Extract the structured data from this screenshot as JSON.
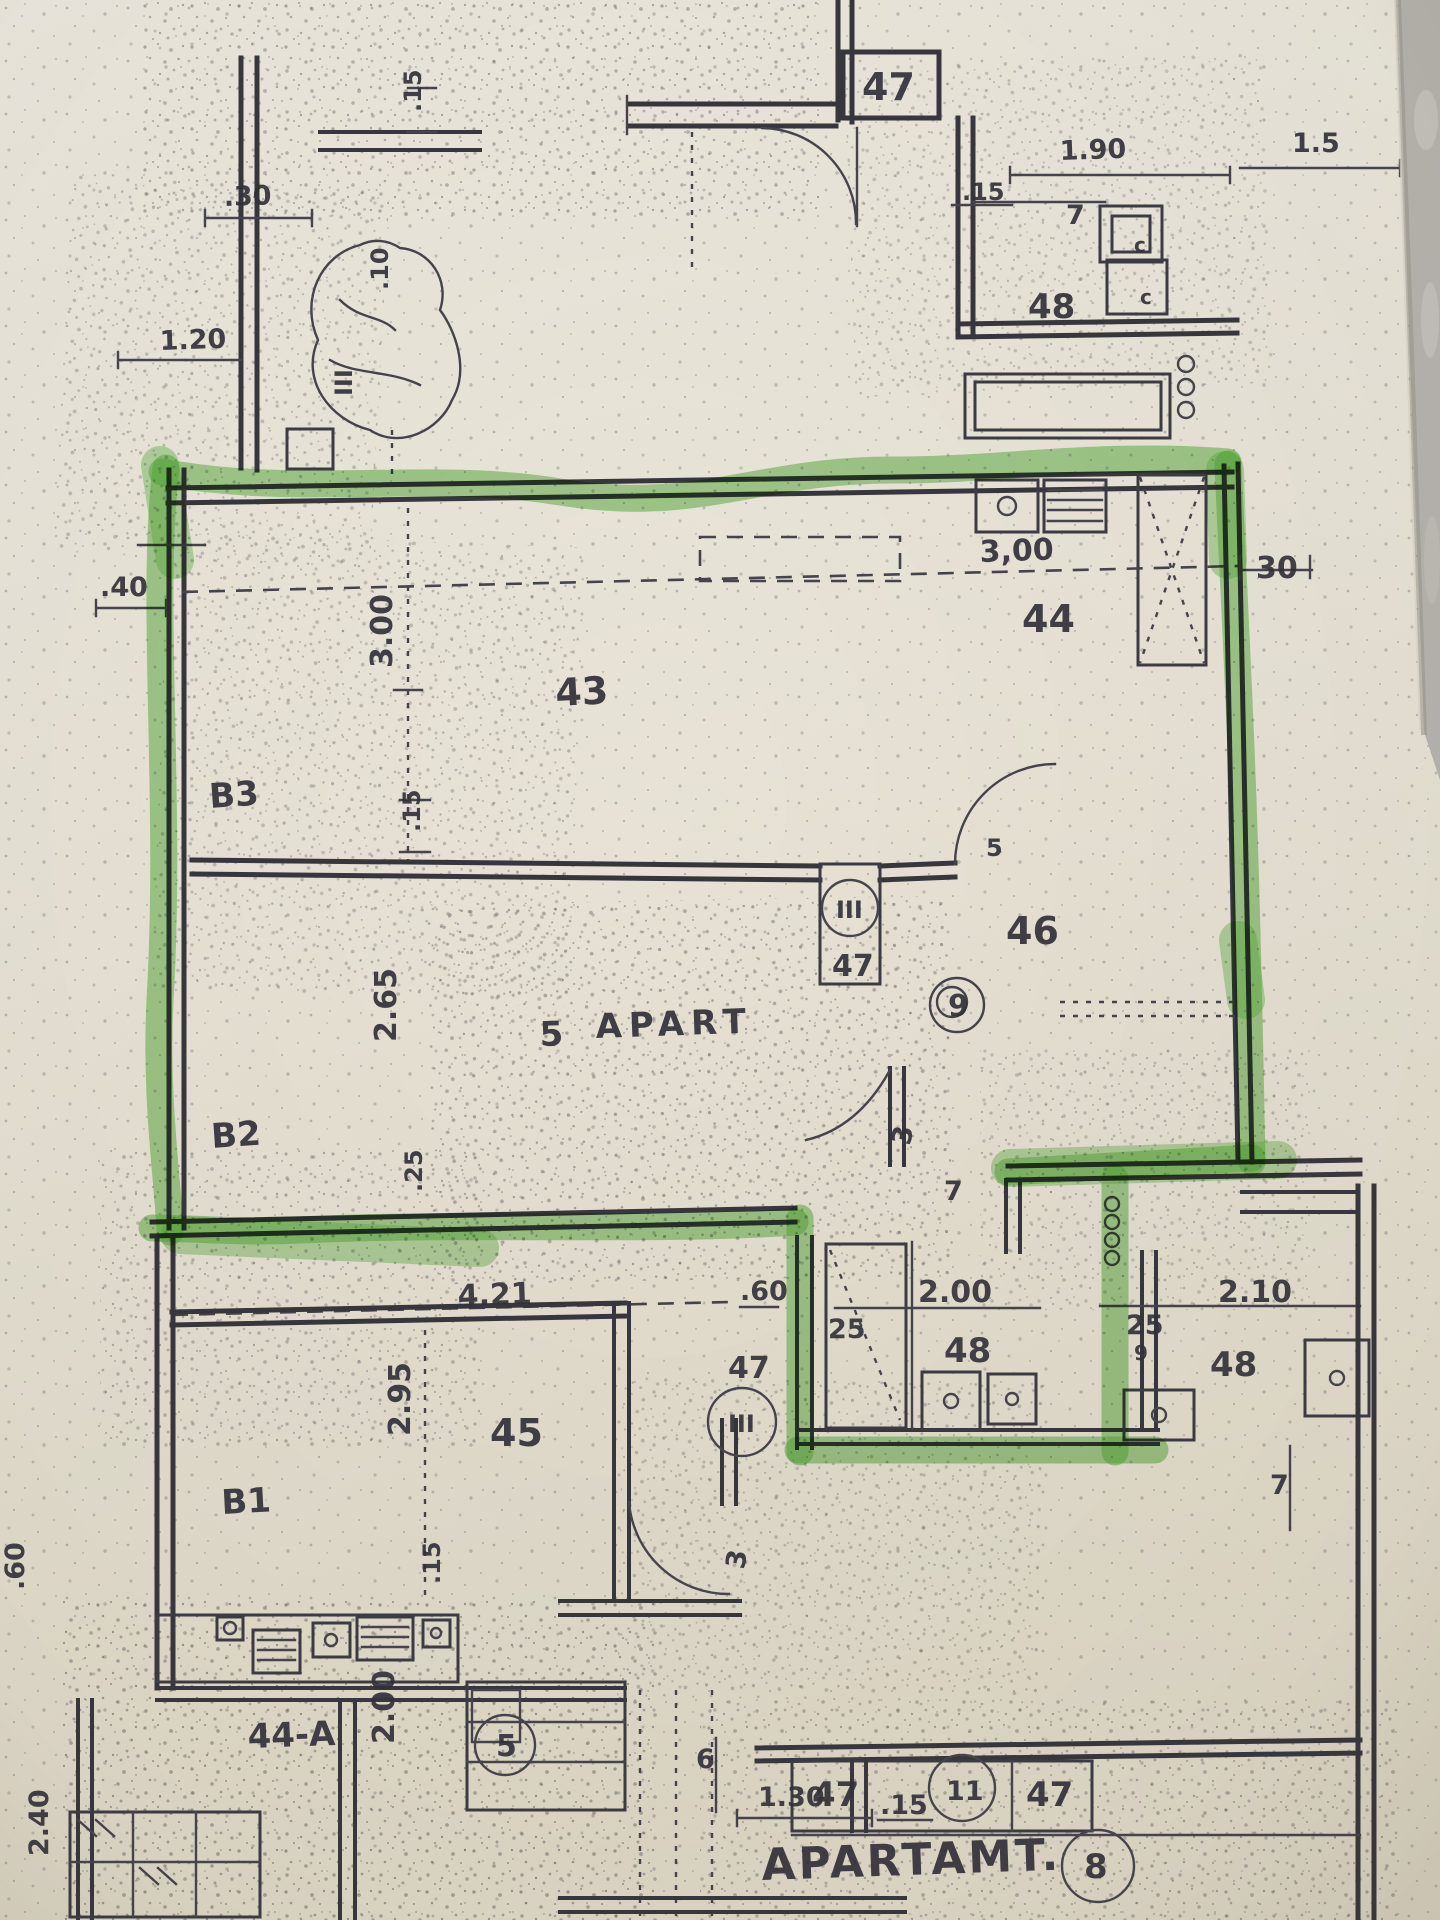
{
  "colors": {
    "paper": "#eae5da",
    "ink": "#37363e",
    "highlight_green": "#58b73d",
    "countertop_gray": "#b6b3ae"
  },
  "plan_labels": {
    "top_left": {
      "dim_30": ".30",
      "dim_120": "1.20",
      "dim_15": ".15",
      "dim_10": ".10",
      "section": "III"
    },
    "top_unit": {
      "room": "47",
      "dim_15": ".15",
      "dim_7": "7",
      "dim_190": "1.90",
      "dim_15_right": "1.5",
      "room_48": "48",
      "fixture_c1": "c",
      "fixture_c2": "c"
    },
    "kitchen": {
      "dim_300": "3,00",
      "dim_30": "30",
      "room": "44"
    },
    "living": {
      "room": "43",
      "bed": "B3",
      "dim_300": "3.00",
      "dim_15": ".15",
      "dim_40": ".40"
    },
    "bedroom": {
      "bed": "B2",
      "dim_265": "2.65",
      "dim_25": ".25"
    },
    "hall": {
      "room": "46",
      "apartment_no": "9",
      "dim_5": "5",
      "dim_3": "3",
      "dim_7": "7",
      "text_5": "5",
      "text_apart": "APART"
    },
    "shaft_top": {
      "mark": "III",
      "room": "47"
    },
    "bath_bottom": {
      "dim_60": ".60",
      "dim_25": "25",
      "dim_200": "2.00",
      "room_48": "48",
      "dim_421": "4.21"
    },
    "bath_right": {
      "dim_210": "2.10",
      "dim_25": "25",
      "dim_9": "9",
      "room_48": "48",
      "dim_7": "7"
    },
    "shaft_bottom": {
      "room": "47",
      "mark": "III"
    },
    "room_45": {
      "room": "45",
      "bed": "B1",
      "dim_295": "2.95",
      "dim_15": ".15",
      "dim_3": "3"
    },
    "margin_left": {
      "dim_60": ".60",
      "dim_240": "2.40"
    },
    "kitchen_44a": {
      "room": "44-A",
      "dim_200": "2.00",
      "stair_no": "5"
    },
    "bottom_dims": {
      "dim_6": "6",
      "dim_130": "1.30",
      "dim_15": ".15"
    },
    "apartment_bottom": {
      "room_47a": "47",
      "stair_no": "11",
      "room_47b": "47",
      "title": "APARTAMT.",
      "apartment_no": "8"
    }
  }
}
